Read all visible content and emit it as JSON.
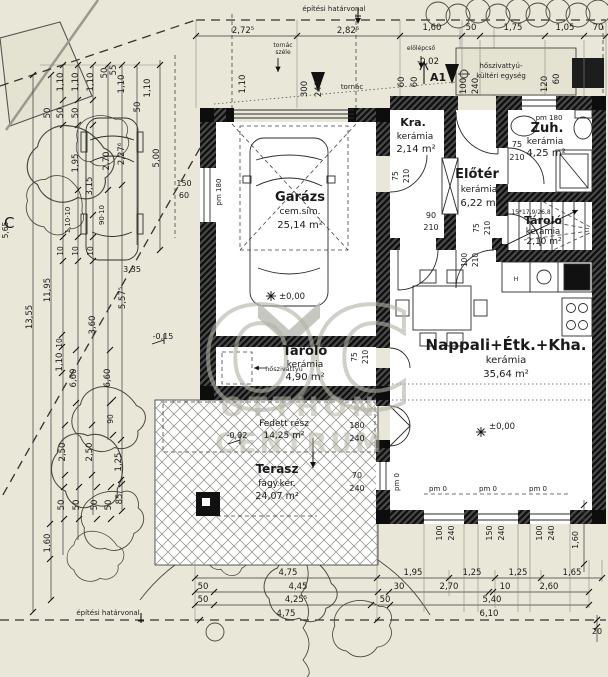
{
  "rooms": {
    "garazs": {
      "name": "Garázs",
      "finish": "cem.sim.",
      "area": "25,14 m²"
    },
    "tarolo1": {
      "name": "Tároló",
      "finish": "kerámia",
      "area": "4,90 m²"
    },
    "kra": {
      "name": "Kra.",
      "finish": "kerámia",
      "area": "2,14 m²"
    },
    "eloter": {
      "name": "Előtér",
      "finish": "kerámia",
      "area": "6,22 m²"
    },
    "zuh": {
      "name": "Zuh.",
      "finish": "kerámia",
      "area": "4,25 m²"
    },
    "tarolo2": {
      "name": "Tároló",
      "finish": "kerámia",
      "area": "2,10 m²"
    },
    "nappali": {
      "name": "Nappali+Étk.+Kha.",
      "finish": "kerámia",
      "area": "35,64 m²"
    },
    "terasz": {
      "name": "Terasz",
      "finish": "fagy.ker.",
      "area": "24,07 m²"
    }
  },
  "annotations": {
    "boundary_top": "építési határvonal",
    "boundary_bottom": "építési határvonal",
    "tornac": "tornác",
    "tornac_szele_1": "tornác",
    "tornac_szele_2": "széle",
    "elolepcso": "előlépcső",
    "heatpump_outdoor_1": "hőszivattyú-",
    "heatpump_outdoor_2": "kültéri egység",
    "heatpump": "hőszivattyú",
    "covered": "Fedett rész",
    "covered_area": "14,25 m²",
    "stairs_note": "15*17,9/26,8",
    "section_mark": "A1",
    "contour_mark": "C"
  },
  "watermark": {
    "monogram": "OC",
    "line1": "OTTHON",
    "line2": "CENTRUM"
  },
  "colors": {
    "background": "#e9e7d8",
    "wall_dark": "#1c1c1c",
    "line": "#333333",
    "watermark": "#b3b2a5",
    "terrace_hatch": "#888888"
  },
  "dim_labels": [
    {
      "t": "2,72⁵",
      "x": 243,
      "y": 33
    },
    {
      "t": "2,82⁵",
      "x": 348,
      "y": 33
    },
    {
      "t": "1,60",
      "x": 432,
      "y": 30
    },
    {
      "t": "50",
      "x": 471,
      "y": 30
    },
    {
      "t": "1,75",
      "x": 513,
      "y": 30
    },
    {
      "t": "1,05",
      "x": 565,
      "y": 30
    },
    {
      "t": "70",
      "x": 598,
      "y": 30
    },
    {
      "t": "1,10",
      "x": 245,
      "y": 84,
      "r": -90
    },
    {
      "t": "300",
      "x": 307,
      "y": 89,
      "r": -90
    },
    {
      "t": "240",
      "x": 321,
      "y": 89,
      "r": -90
    },
    {
      "t": "60",
      "x": 404,
      "y": 82,
      "r": -90
    },
    {
      "t": "60",
      "x": 417,
      "y": 82,
      "r": -90
    },
    {
      "t": "100",
      "x": 466,
      "y": 86,
      "r": -90
    },
    {
      "t": "240",
      "x": 478,
      "y": 86,
      "r": -90
    },
    {
      "t": "-0,02",
      "x": 428,
      "y": 64
    },
    {
      "t": "120",
      "x": 547,
      "y": 84,
      "r": -90
    },
    {
      "t": "60",
      "x": 559,
      "y": 79,
      "r": -90
    },
    {
      "t": "pm 180",
      "x": 549,
      "y": 120,
      "s": 7
    },
    {
      "t": "pm 180",
      "x": 221,
      "y": 192,
      "r": -90,
      "s": 7
    },
    {
      "t": "150",
      "x": 184,
      "y": 186,
      "s": 8
    },
    {
      "t": "60",
      "x": 184,
      "y": 198,
      "s": 8
    },
    {
      "t": "5,00",
      "x": 159,
      "y": 158,
      "r": -90
    },
    {
      "t": "75",
      "x": 398,
      "y": 176,
      "r": -90,
      "s": 7.5
    },
    {
      "t": "210",
      "x": 409,
      "y": 176,
      "r": -90,
      "s": 7.5
    },
    {
      "t": "90",
      "x": 431,
      "y": 218,
      "s": 8
    },
    {
      "t": "210",
      "x": 431,
      "y": 230,
      "s": 8
    },
    {
      "t": "75",
      "x": 517,
      "y": 147,
      "s": 8
    },
    {
      "t": "210",
      "x": 517,
      "y": 160,
      "s": 8
    },
    {
      "t": "75",
      "x": 479,
      "y": 228,
      "r": -90,
      "s": 7.5
    },
    {
      "t": "210",
      "x": 490,
      "y": 228,
      "r": -90,
      "s": 7.5
    },
    {
      "t": "100",
      "x": 467,
      "y": 260,
      "r": -90,
      "s": 7.5
    },
    {
      "t": "210",
      "x": 478,
      "y": 260,
      "r": -90,
      "s": 7.5
    },
    {
      "t": "75",
      "x": 357,
      "y": 357,
      "r": -90,
      "s": 7.5
    },
    {
      "t": "210",
      "x": 368,
      "y": 357,
      "r": -90,
      "s": 7.5
    },
    {
      "t": "180",
      "x": 357,
      "y": 428,
      "s": 8
    },
    {
      "t": "240",
      "x": 357,
      "y": 441,
      "s": 8
    },
    {
      "t": "70",
      "x": 357,
      "y": 478,
      "s": 8
    },
    {
      "t": "240",
      "x": 357,
      "y": 491,
      "s": 8
    },
    {
      "t": "pm 0",
      "x": 399,
      "y": 482,
      "r": -90,
      "s": 7
    },
    {
      "t": "pm 0",
      "x": 438,
      "y": 491,
      "s": 7
    },
    {
      "t": "pm 0",
      "x": 488,
      "y": 491,
      "s": 7
    },
    {
      "t": "pm 0",
      "x": 538,
      "y": 491,
      "s": 7
    },
    {
      "t": "100",
      "x": 442,
      "y": 533,
      "r": -90,
      "s": 8
    },
    {
      "t": "240",
      "x": 454,
      "y": 533,
      "r": -90,
      "s": 8
    },
    {
      "t": "150",
      "x": 492,
      "y": 533,
      "r": -90,
      "s": 8
    },
    {
      "t": "240",
      "x": 504,
      "y": 533,
      "r": -90,
      "s": 8
    },
    {
      "t": "100",
      "x": 542,
      "y": 533,
      "r": -90,
      "s": 8
    },
    {
      "t": "240",
      "x": 554,
      "y": 533,
      "r": -90,
      "s": 8
    },
    {
      "t": "1,60",
      "x": 578,
      "y": 540,
      "r": -90,
      "s": 8
    },
    {
      "t": "±0,00",
      "x": 292,
      "y": 299,
      "s": 8.5
    },
    {
      "t": "±0,00",
      "x": 502,
      "y": 429,
      "s": 8.5
    },
    {
      "t": "-0,02",
      "x": 237,
      "y": 438,
      "s": 8
    },
    {
      "t": "-0,15",
      "x": 163,
      "y": 339,
      "s": 8
    },
    {
      "t": "H",
      "x": 516,
      "y": 281,
      "s": 6
    },
    {
      "t": "20",
      "x": 597,
      "y": 634,
      "s": 8
    },
    {
      "t": "1,10",
      "x": 63,
      "y": 82,
      "r": -90
    },
    {
      "t": "1,10",
      "x": 78,
      "y": 82,
      "r": -90
    },
    {
      "t": "1,10",
      "x": 93,
      "y": 82,
      "r": -90
    },
    {
      "t": "50",
      "x": 107,
      "y": 73,
      "r": -90
    },
    {
      "t": "55",
      "x": 116,
      "y": 70,
      "r": -90
    },
    {
      "t": "1,10",
      "x": 124,
      "y": 84,
      "r": -90
    },
    {
      "t": "1,10",
      "x": 150,
      "y": 88,
      "r": -90
    },
    {
      "t": "50",
      "x": 50,
      "y": 113,
      "r": -90
    },
    {
      "t": "50",
      "x": 63,
      "y": 113,
      "r": -90
    },
    {
      "t": "50",
      "x": 78,
      "y": 113,
      "r": -90
    },
    {
      "t": "50",
      "x": 140,
      "y": 107,
      "r": -90
    },
    {
      "t": "1,95",
      "x": 78,
      "y": 163,
      "r": -90
    },
    {
      "t": "3,15",
      "x": 92,
      "y": 186,
      "r": -90
    },
    {
      "t": "2,70",
      "x": 109,
      "y": 161,
      "r": -90
    },
    {
      "t": "2,27⁶",
      "x": 124,
      "y": 154,
      "r": -90
    },
    {
      "t": "1,10·10",
      "x": 70,
      "y": 220,
      "r": -90,
      "s": 7
    },
    {
      "t": "90·10",
      "x": 104,
      "y": 215,
      "r": -90,
      "s": 7
    },
    {
      "t": "5,65",
      "x": 8,
      "y": 230,
      "r": -90,
      "s": 7.5
    },
    {
      "t": "10",
      "x": 63,
      "y": 251,
      "r": -90,
      "s": 7.5
    },
    {
      "t": "10",
      "x": 78,
      "y": 251,
      "r": -90,
      "s": 7.5
    },
    {
      "t": "10",
      "x": 93,
      "y": 251,
      "r": -90,
      "s": 7.5
    },
    {
      "t": "13,55",
      "x": 32,
      "y": 317,
      "r": -90
    },
    {
      "t": "11,95",
      "x": 50,
      "y": 290,
      "r": -90
    },
    {
      "t": "3,35",
      "x": 132,
      "y": 272,
      "s": 8
    },
    {
      "t": "5,57⁵",
      "x": 125,
      "y": 298,
      "r": -90
    },
    {
      "t": "3,60",
      "x": 95,
      "y": 325,
      "r": -90
    },
    {
      "t": "10",
      "x": 62,
      "y": 343,
      "r": -90,
      "s": 7.5
    },
    {
      "t": "1,10",
      "x": 62,
      "y": 362,
      "r": -90
    },
    {
      "t": "6,60",
      "x": 76,
      "y": 378,
      "r": -90
    },
    {
      "t": "6,60",
      "x": 110,
      "y": 378,
      "r": -90
    },
    {
      "t": "90",
      "x": 113,
      "y": 419,
      "r": -90,
      "s": 7.5
    },
    {
      "t": "2,50",
      "x": 65,
      "y": 452,
      "r": -90
    },
    {
      "t": "2,50",
      "x": 92,
      "y": 452,
      "r": -90
    },
    {
      "t": "1,25",
      "x": 121,
      "y": 462,
      "r": -90
    },
    {
      "t": "50",
      "x": 64,
      "y": 505,
      "r": -90
    },
    {
      "t": "50",
      "x": 79,
      "y": 505,
      "r": -90
    },
    {
      "t": "50",
      "x": 97,
      "y": 505,
      "r": -90
    },
    {
      "t": "50",
      "x": 111,
      "y": 505,
      "r": -90
    },
    {
      "t": "85",
      "x": 122,
      "y": 499,
      "r": -90
    },
    {
      "t": "1,60",
      "x": 50,
      "y": 543,
      "r": -90
    },
    {
      "t": "4,75",
      "x": 288,
      "y": 575
    },
    {
      "t": "1,95",
      "x": 413,
      "y": 575
    },
    {
      "t": "1,25",
      "x": 472,
      "y": 575
    },
    {
      "t": "1,25",
      "x": 518,
      "y": 575
    },
    {
      "t": "1,65",
      "x": 572,
      "y": 575
    },
    {
      "t": "50",
      "x": 203,
      "y": 589
    },
    {
      "t": "4,45",
      "x": 298,
      "y": 589
    },
    {
      "t": "30",
      "x": 399,
      "y": 589
    },
    {
      "t": "2,70",
      "x": 449,
      "y": 589
    },
    {
      "t": "10",
      "x": 505,
      "y": 589
    },
    {
      "t": "2,60",
      "x": 549,
      "y": 589
    },
    {
      "t": "50",
      "x": 203,
      "y": 602
    },
    {
      "t": "4,25⁵",
      "x": 296,
      "y": 602
    },
    {
      "t": "50",
      "x": 385,
      "y": 602
    },
    {
      "t": "5,40",
      "x": 492,
      "y": 602
    },
    {
      "t": "4,75",
      "x": 286,
      "y": 616
    },
    {
      "t": "6,10",
      "x": 489,
      "y": 616
    }
  ]
}
